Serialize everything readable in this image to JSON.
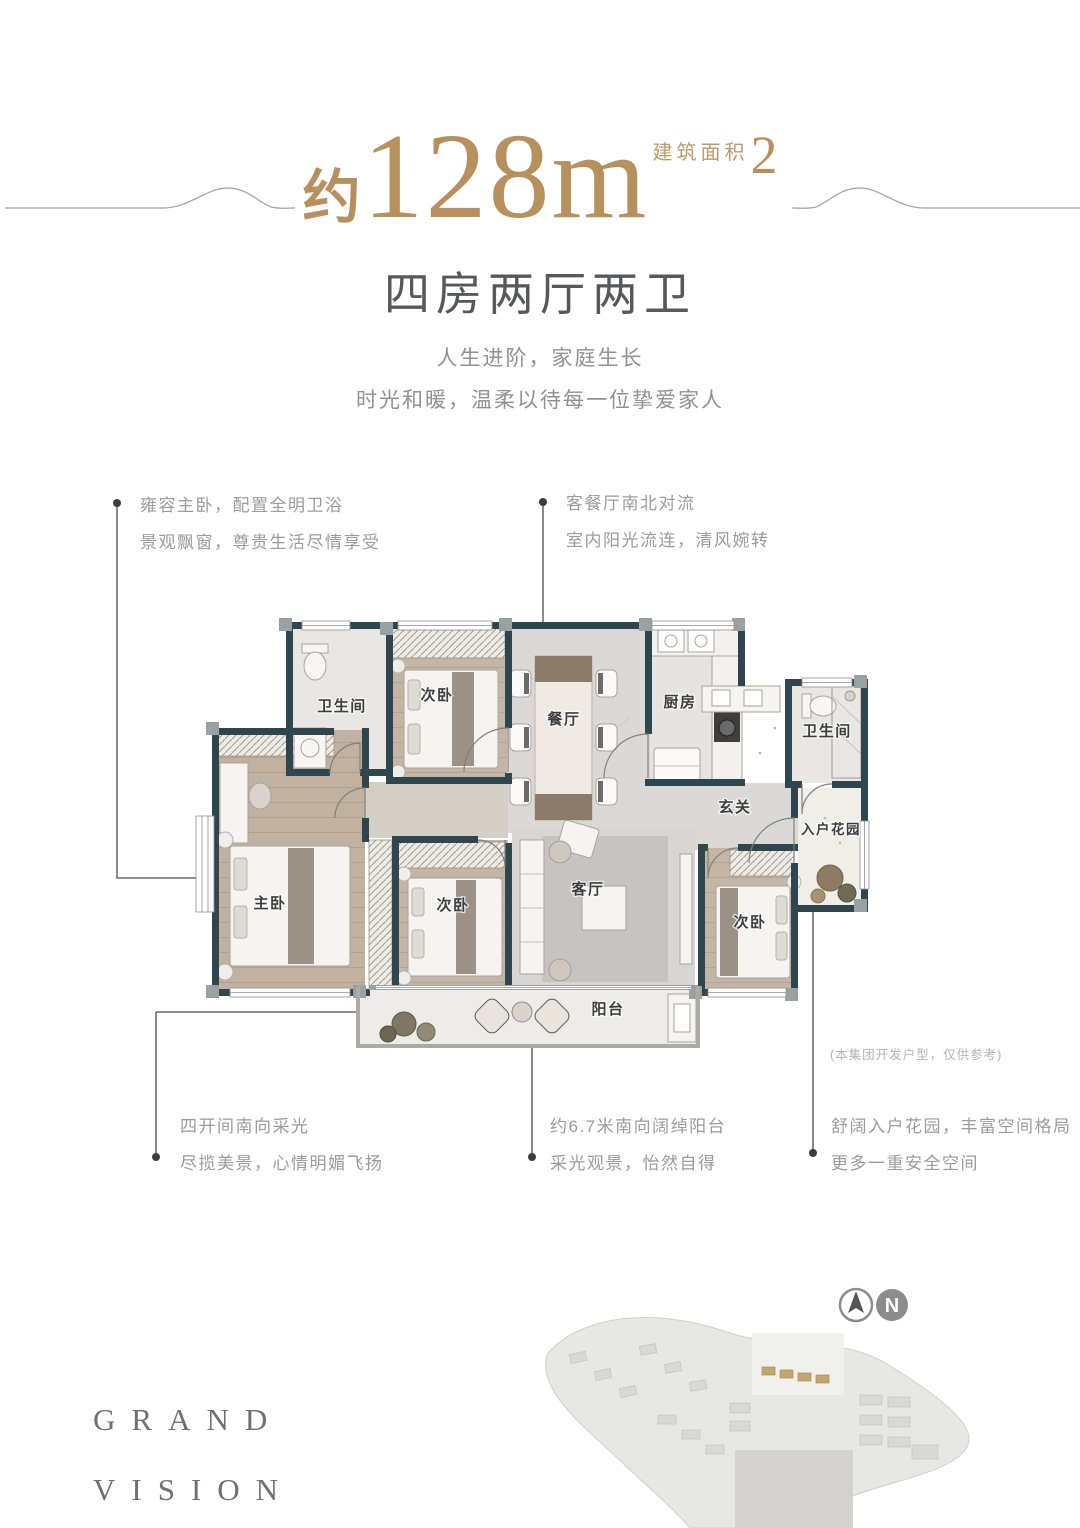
{
  "header": {
    "area_prefix": "约",
    "area_number": "128m",
    "area_superscript": "2",
    "area_label": "建筑面积",
    "subtitle": "四房两厅两卫",
    "tagline_line1": "人生进阶，家庭生长",
    "tagline_line2": "时光和暖，温柔以待每一位挚爱家人"
  },
  "callouts": {
    "master": {
      "line1": "雍容主卧，配置全明卫浴",
      "line2": "景观飘窗，尊贵生活尽情享受"
    },
    "living_dining": {
      "line1": "客餐厅南北对流",
      "line2": "室内阳光流连，清风婉转"
    },
    "south_bays": {
      "line1": "四开间南向采光",
      "line2": "尽揽美景，心情明媚飞扬"
    },
    "balcony": {
      "line1": "约6.7米南向阔绰阳台",
      "line2": "采光观景，怡然自得"
    },
    "entry_garden": {
      "line1": "舒阔入户花园，丰富空间格局",
      "line2": "更多一重安全空间"
    }
  },
  "floorplan": {
    "rooms": [
      {
        "label": "卫生间"
      },
      {
        "label": "次卧"
      },
      {
        "label": "餐厅"
      },
      {
        "label": "厨房"
      },
      {
        "label": "卫生间"
      },
      {
        "label": "玄关"
      },
      {
        "label": "入户花园"
      },
      {
        "label": "主卧"
      },
      {
        "label": "次卧"
      },
      {
        "label": "客厅"
      },
      {
        "label": "次卧"
      },
      {
        "label": "阳台"
      }
    ],
    "disclaimer": "(本集团开发户型，仅供参考)"
  },
  "footer": {
    "brand_line1": "GRAND",
    "brand_line2": "VISION",
    "compass_label": "N"
  },
  "colors": {
    "accent": "#b6915e",
    "wall": "#30464f"
  }
}
